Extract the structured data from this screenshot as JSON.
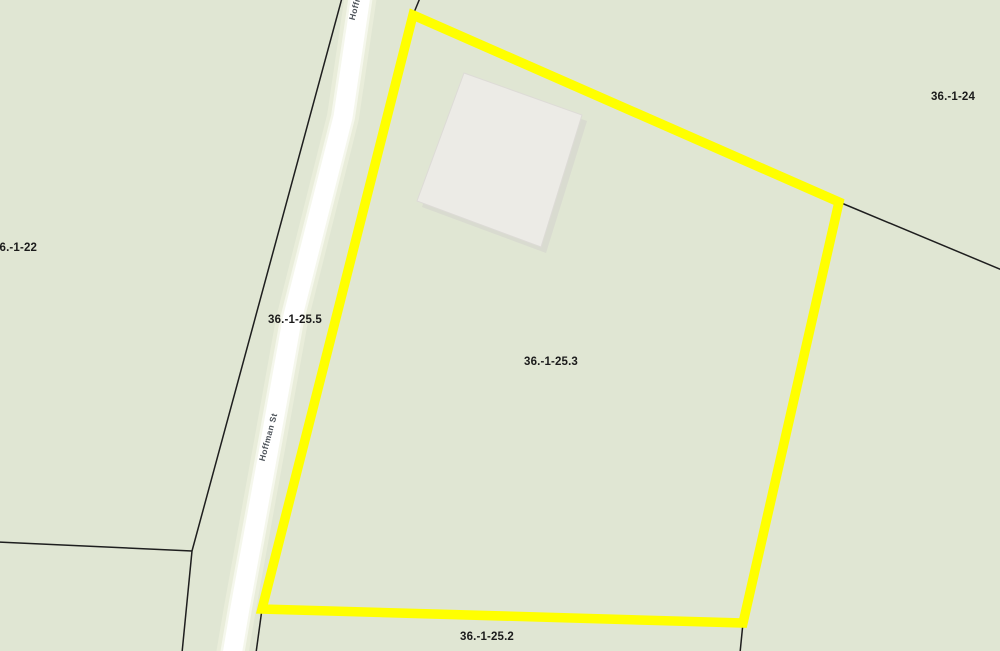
{
  "map": {
    "road": {
      "name": "Hoffman St"
    },
    "parcel_labels": [
      {
        "id": "36-1-24",
        "label": "36.-1-24"
      },
      {
        "id": "36-1-22",
        "label": "36.-1-22"
      },
      {
        "id": "36-1-25-5",
        "label": "36.-1-25.5"
      },
      {
        "id": "36-1-25-3",
        "label": "36.-1-25.3"
      },
      {
        "id": "36-1-25-2",
        "label": "36.-1-25.2"
      }
    ],
    "colors": {
      "background": "#e0e6d3",
      "parcel_line": "#1e1e1e",
      "highlight": "#ffff00",
      "road_fill": "#ffffff",
      "road_halo": "#edf0e0",
      "building_fill": "#ecebe6",
      "building_shadow": "#d3d2cd",
      "label_text": "#1b1b1b",
      "road_label_text": "#4b5158"
    }
  }
}
